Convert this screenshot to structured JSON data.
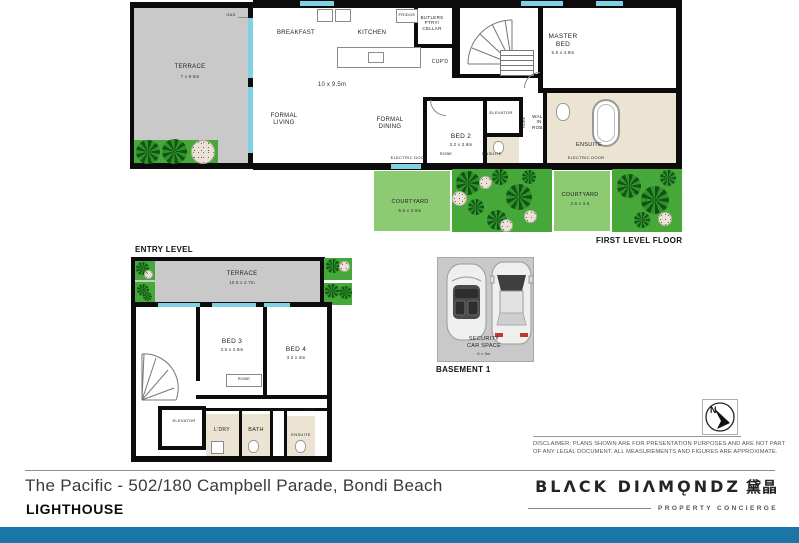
{
  "first_level": {
    "caption": "FIRST LEVEL FLOOR",
    "terrace": {
      "label": "TERRACE",
      "dim": "7 x 9.5m"
    },
    "gas_label": "GAS",
    "breakfast_label": "BREAKFAST",
    "kitchen_label": "KITCHEN",
    "open_plan_dim": "10 x 9.5m",
    "formal_living_label": "FORMAL LIVING",
    "formal_dining_label": "FORMAL DINING",
    "fridge_label": "FRIDGE",
    "butlers_label": "BUTLERS PTRY/ CELLAR",
    "cupd_label": "CUP'D",
    "master_bed": {
      "label": "MASTER BED",
      "dim": "5.5 x 4.8m"
    },
    "bed2": {
      "label": "BED 2",
      "dim": "3.2 x 3.8m"
    },
    "elevator_label": "ELEVATOR",
    "walk_in_robe_label": "WALK IN ROBE",
    "robe_label": "ROBE",
    "robe2_label": "ROBE",
    "ensuite_label": "ENSUITE",
    "ensuite2_label": "ENSUITE",
    "electric_door_label": "ELECTRIC DOOR",
    "electric_door2_label": "ELECTRIC DOOR",
    "courtyard1": {
      "label": "COURTYARD",
      "dim": "5.5 x 3.6m"
    },
    "courtyard2": {
      "label": "COURTYARD",
      "dim": "2.6 x 3.6"
    }
  },
  "entry_level": {
    "caption": "ENTRY LEVEL",
    "terrace": {
      "label": "TERRACE",
      "dim": "10.5 x 2.7m"
    },
    "bed3": {
      "label": "BED 3",
      "dim": "3.5 x 2.8m"
    },
    "bed4": {
      "label": "BED 4",
      "dim": "3.2 x 3m"
    },
    "robe_label": "ROBE",
    "robe2_label": "ROBE",
    "robe3_label": "ROBE",
    "robe4_label": "ROBE",
    "elevator_label": "ELEVATOR",
    "laundry_label": "L'DRY",
    "bath_label": "BATH",
    "ensuite_label": "ENSUITE"
  },
  "basement": {
    "caption": "BASEMENT 1",
    "car_space_label": "SECURITY CAR SPACE",
    "car_space_dim": "6 x 5m"
  },
  "compass": {
    "north": "N"
  },
  "disclaimer": {
    "line1": "DISCLAIMER:  PLANS SHOWN ARE FOR PRESENTATION PURPOSES AND ARE NOT PART",
    "line2": "OF ANY LEGAL DOCUMENT. ALL MEASUREMENTS AND FIGURES ARE APPROXIMATE."
  },
  "footer": {
    "address": "The Pacific - 502/180 Campbell Parade, Bondi Beach",
    "subtitle": "LIGHTHOUSE",
    "brand": {
      "name": "BLACK DIAMONDZ",
      "name_stylized": "BLΛCK DIΛMǪNDZ",
      "chinese": "黛晶",
      "tagline": "PROPERTY CONCIERGE"
    },
    "accent_color": "#1b76a8"
  }
}
